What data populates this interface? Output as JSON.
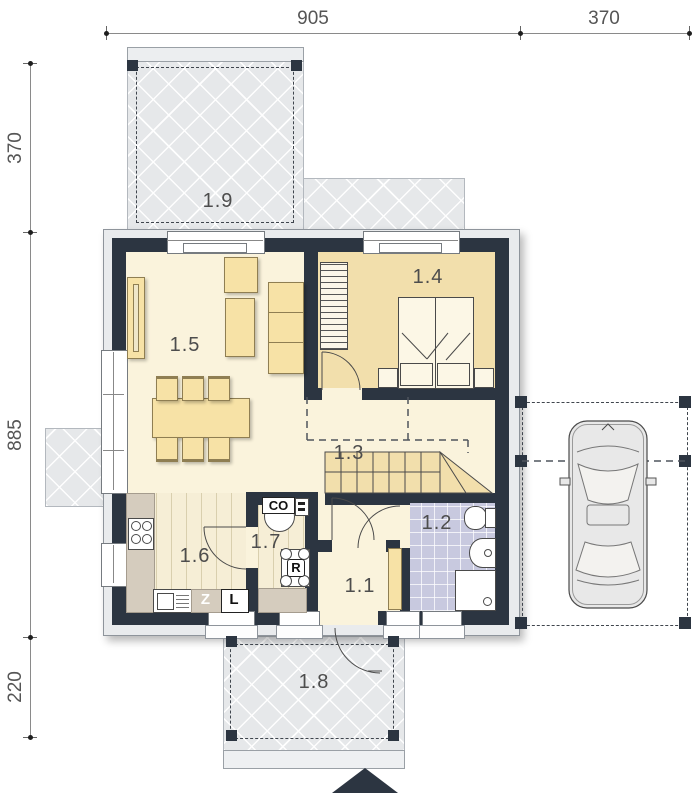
{
  "dimensions": {
    "top": [
      {
        "value": "905"
      },
      {
        "value": "370"
      }
    ],
    "left": [
      {
        "value": "370"
      },
      {
        "value": "885"
      },
      {
        "value": "220"
      }
    ]
  },
  "rooms": {
    "entry": "1.1",
    "bathroom": "1.2",
    "hall": "1.3",
    "bedroom": "1.4",
    "living": "1.5",
    "kitchen": "1.6",
    "utility": "1.7",
    "terrace_front": "1.8",
    "terrace_garden": "1.9"
  },
  "appliances": {
    "boiler": "CO",
    "vent_unit": "R",
    "dishwasher": "Z",
    "fridge": "L"
  },
  "colors": {
    "wall": "#2c3541",
    "floor_cream": "#faf3dc",
    "floor_bedroom": "#f2dfac",
    "floor_bath": "#c8c9df",
    "terrace": "#e6e8ea",
    "furniture": "#f7e2a6"
  }
}
